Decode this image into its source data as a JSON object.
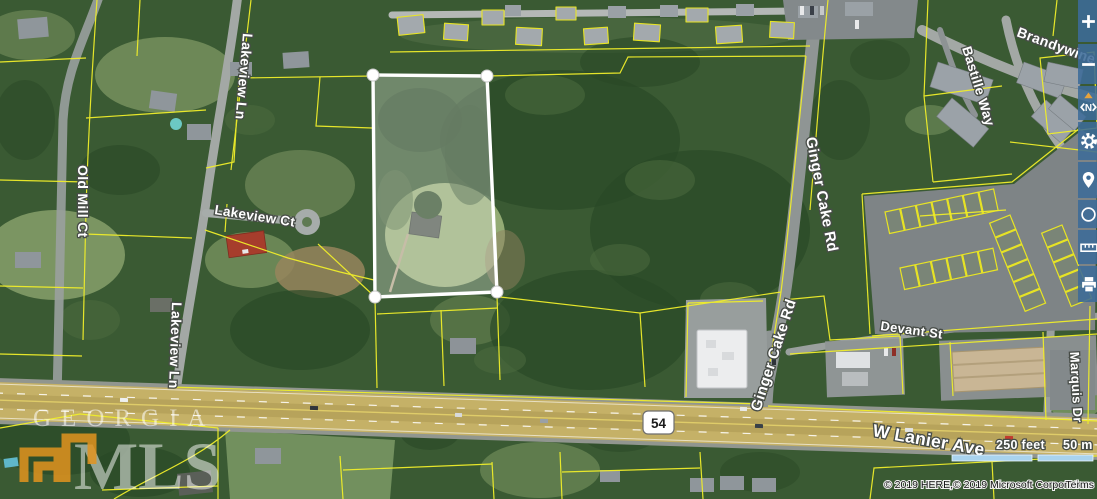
{
  "map": {
    "road_labels": {
      "old_mill_ct": "Old Mill Ct",
      "lakeview_ln": "Lakeview Ln",
      "lakeview_ct": "Lakeview Ct",
      "ginger_cake_rd": "Ginger Cake Rd",
      "brandywine": "Brandywine P",
      "bastille_way": "Bastille Way",
      "devant_st": "Devant St",
      "marquis_dr": "Marquis Dr",
      "w_lanier_ave": "W Lanier Ave"
    },
    "highway_shield": "54",
    "scale_bar": {
      "feet_label": "250 feet",
      "meters_label": "50 m"
    },
    "attribution": "© 2019 HERE,© 2019 Microsoft Corporation",
    "terms_link": "Terms",
    "watermark": {
      "name": "Georgia MLS",
      "line1": "GEORGIA",
      "line2": "MLS"
    },
    "colors": {
      "parcel_line": "#f0ee2a",
      "selected_parcel_outline": "#ffffff",
      "toolbar_blue": "#3c6b98",
      "scalebar_fill": "#a9d3ee",
      "watermark_orange": "#e2941f"
    }
  },
  "toolbar": {
    "compass_n": "N",
    "buttons": [
      {
        "name": "zoom-in",
        "icon": "plus-icon"
      },
      {
        "name": "zoom-out",
        "icon": "minus-icon"
      },
      {
        "name": "rotate-view",
        "icon": "compass-icon"
      },
      {
        "name": "map-settings",
        "icon": "gear-icon"
      },
      {
        "name": "my-location",
        "icon": "location-pin-icon"
      },
      {
        "name": "radius-search",
        "icon": "circle-icon"
      },
      {
        "name": "measure-distance",
        "icon": "ruler-icon"
      },
      {
        "name": "print-map",
        "icon": "printer-icon"
      }
    ]
  }
}
